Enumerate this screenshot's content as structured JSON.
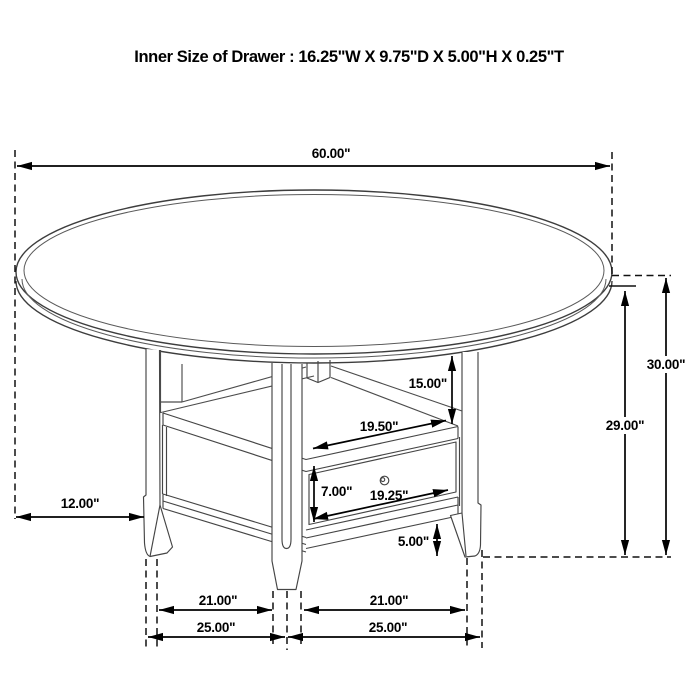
{
  "title": "Inner Size of Drawer : 16.25\"W X 9.75\"D X 5.00\"H X 0.25\"T",
  "dims": {
    "table_diameter": "60.00\"",
    "total_height": "30.00\"",
    "floor_to_apron_height": "29.00\"",
    "top_to_shelf": "15.00\"",
    "shelf_opening_width": "19.50\"",
    "drawer_opening_height": "7.00\"",
    "drawer_width": "19.25\"",
    "bottom_rail_clearance": "5.00\"",
    "top_overhang": "12.00\"",
    "leg_spacing_inner_left": "21.00\"",
    "leg_spacing_inner_right": "21.00\"",
    "base_span_left": "25.00\"",
    "base_span_right": "25.00\""
  },
  "colors": {
    "line": "#454545",
    "dimension": "#000000",
    "background": "#ffffff"
  }
}
